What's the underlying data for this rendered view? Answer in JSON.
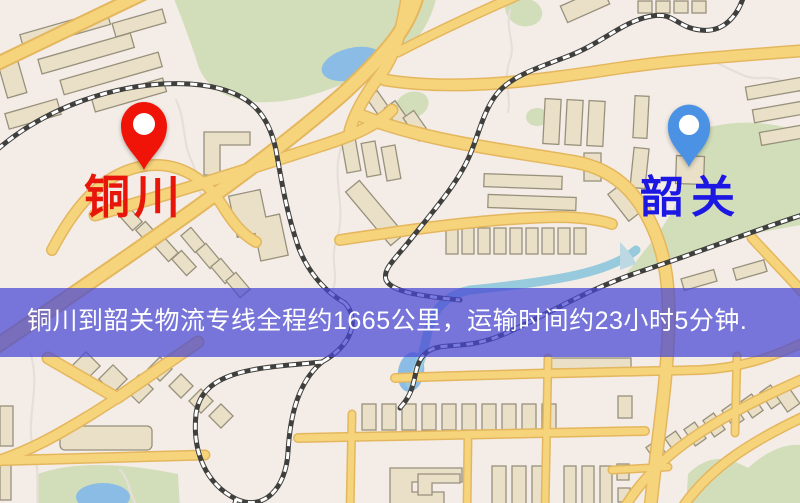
{
  "map": {
    "origin": {
      "label": "铜川",
      "label_color": "#e8150b",
      "pin_color": "#f01408"
    },
    "destination": {
      "label": "韶关",
      "label_color": "#1c17e2",
      "pin_color": "#4b92e5"
    },
    "banner": {
      "text": "铜川到韶关物流专线全程约1665公里，运输时间约23小时5分钟.",
      "background": "rgba(70,70,212,0.72)",
      "text_color": "#ffffff"
    },
    "palette": {
      "background": "#f4ece6",
      "road": "#f6d47c",
      "road_casing": "#e4b75e",
      "building": "#eae0c8",
      "park": "#d2deba",
      "water": "#8abce6",
      "railway": "#3f3f3d"
    }
  }
}
